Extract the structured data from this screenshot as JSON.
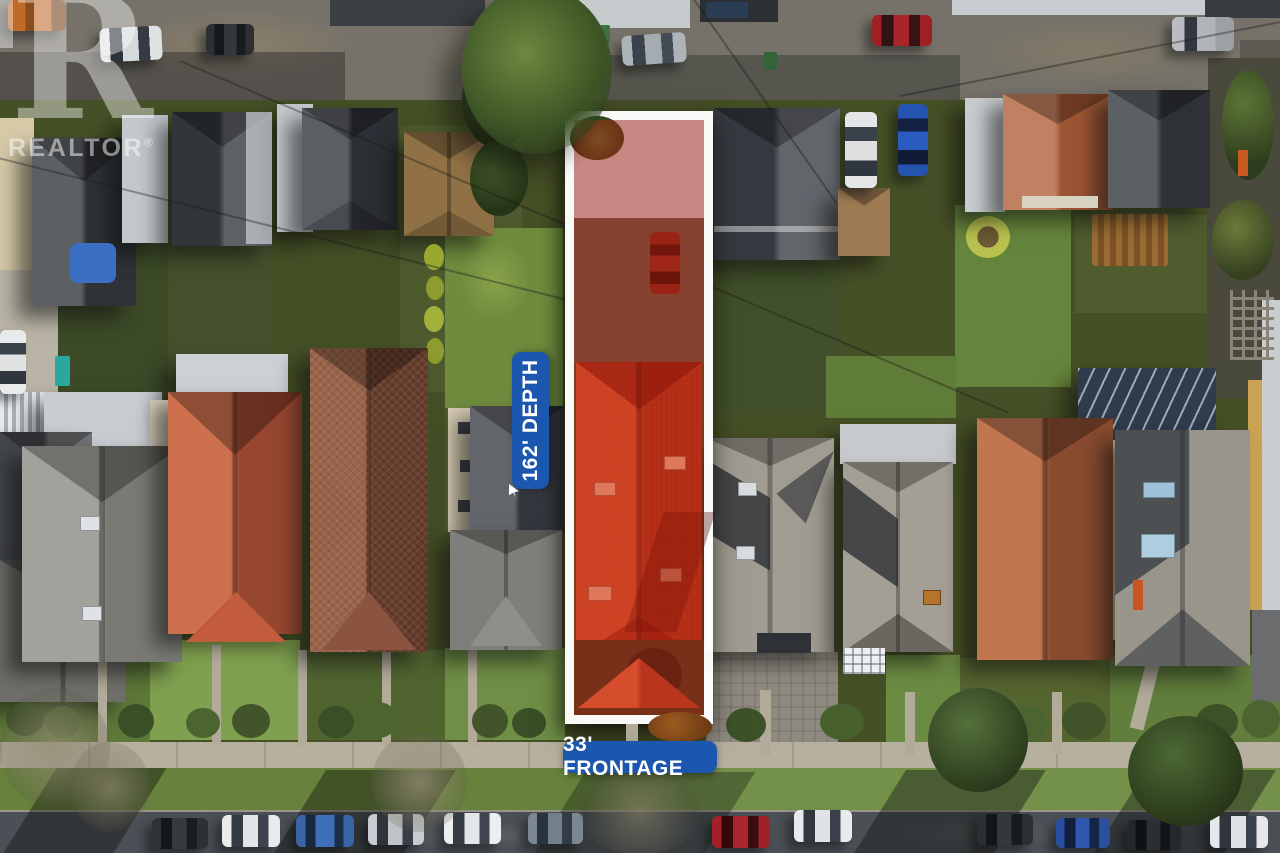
{
  "watermark": {
    "logo_letter": "R",
    "brand": "REALTOR",
    "registered_mark": "®"
  },
  "labels": {
    "depth": "162' DEPTH",
    "frontage": "33' FRONTAGE"
  },
  "colors": {
    "annotation_blue": "#1b57ae",
    "lot_outline_white": "#ffffff",
    "lot_overlay_red": "rgba(199,36,18,0.40)",
    "watermark_white": "rgba(255,255,255,0.5)"
  }
}
